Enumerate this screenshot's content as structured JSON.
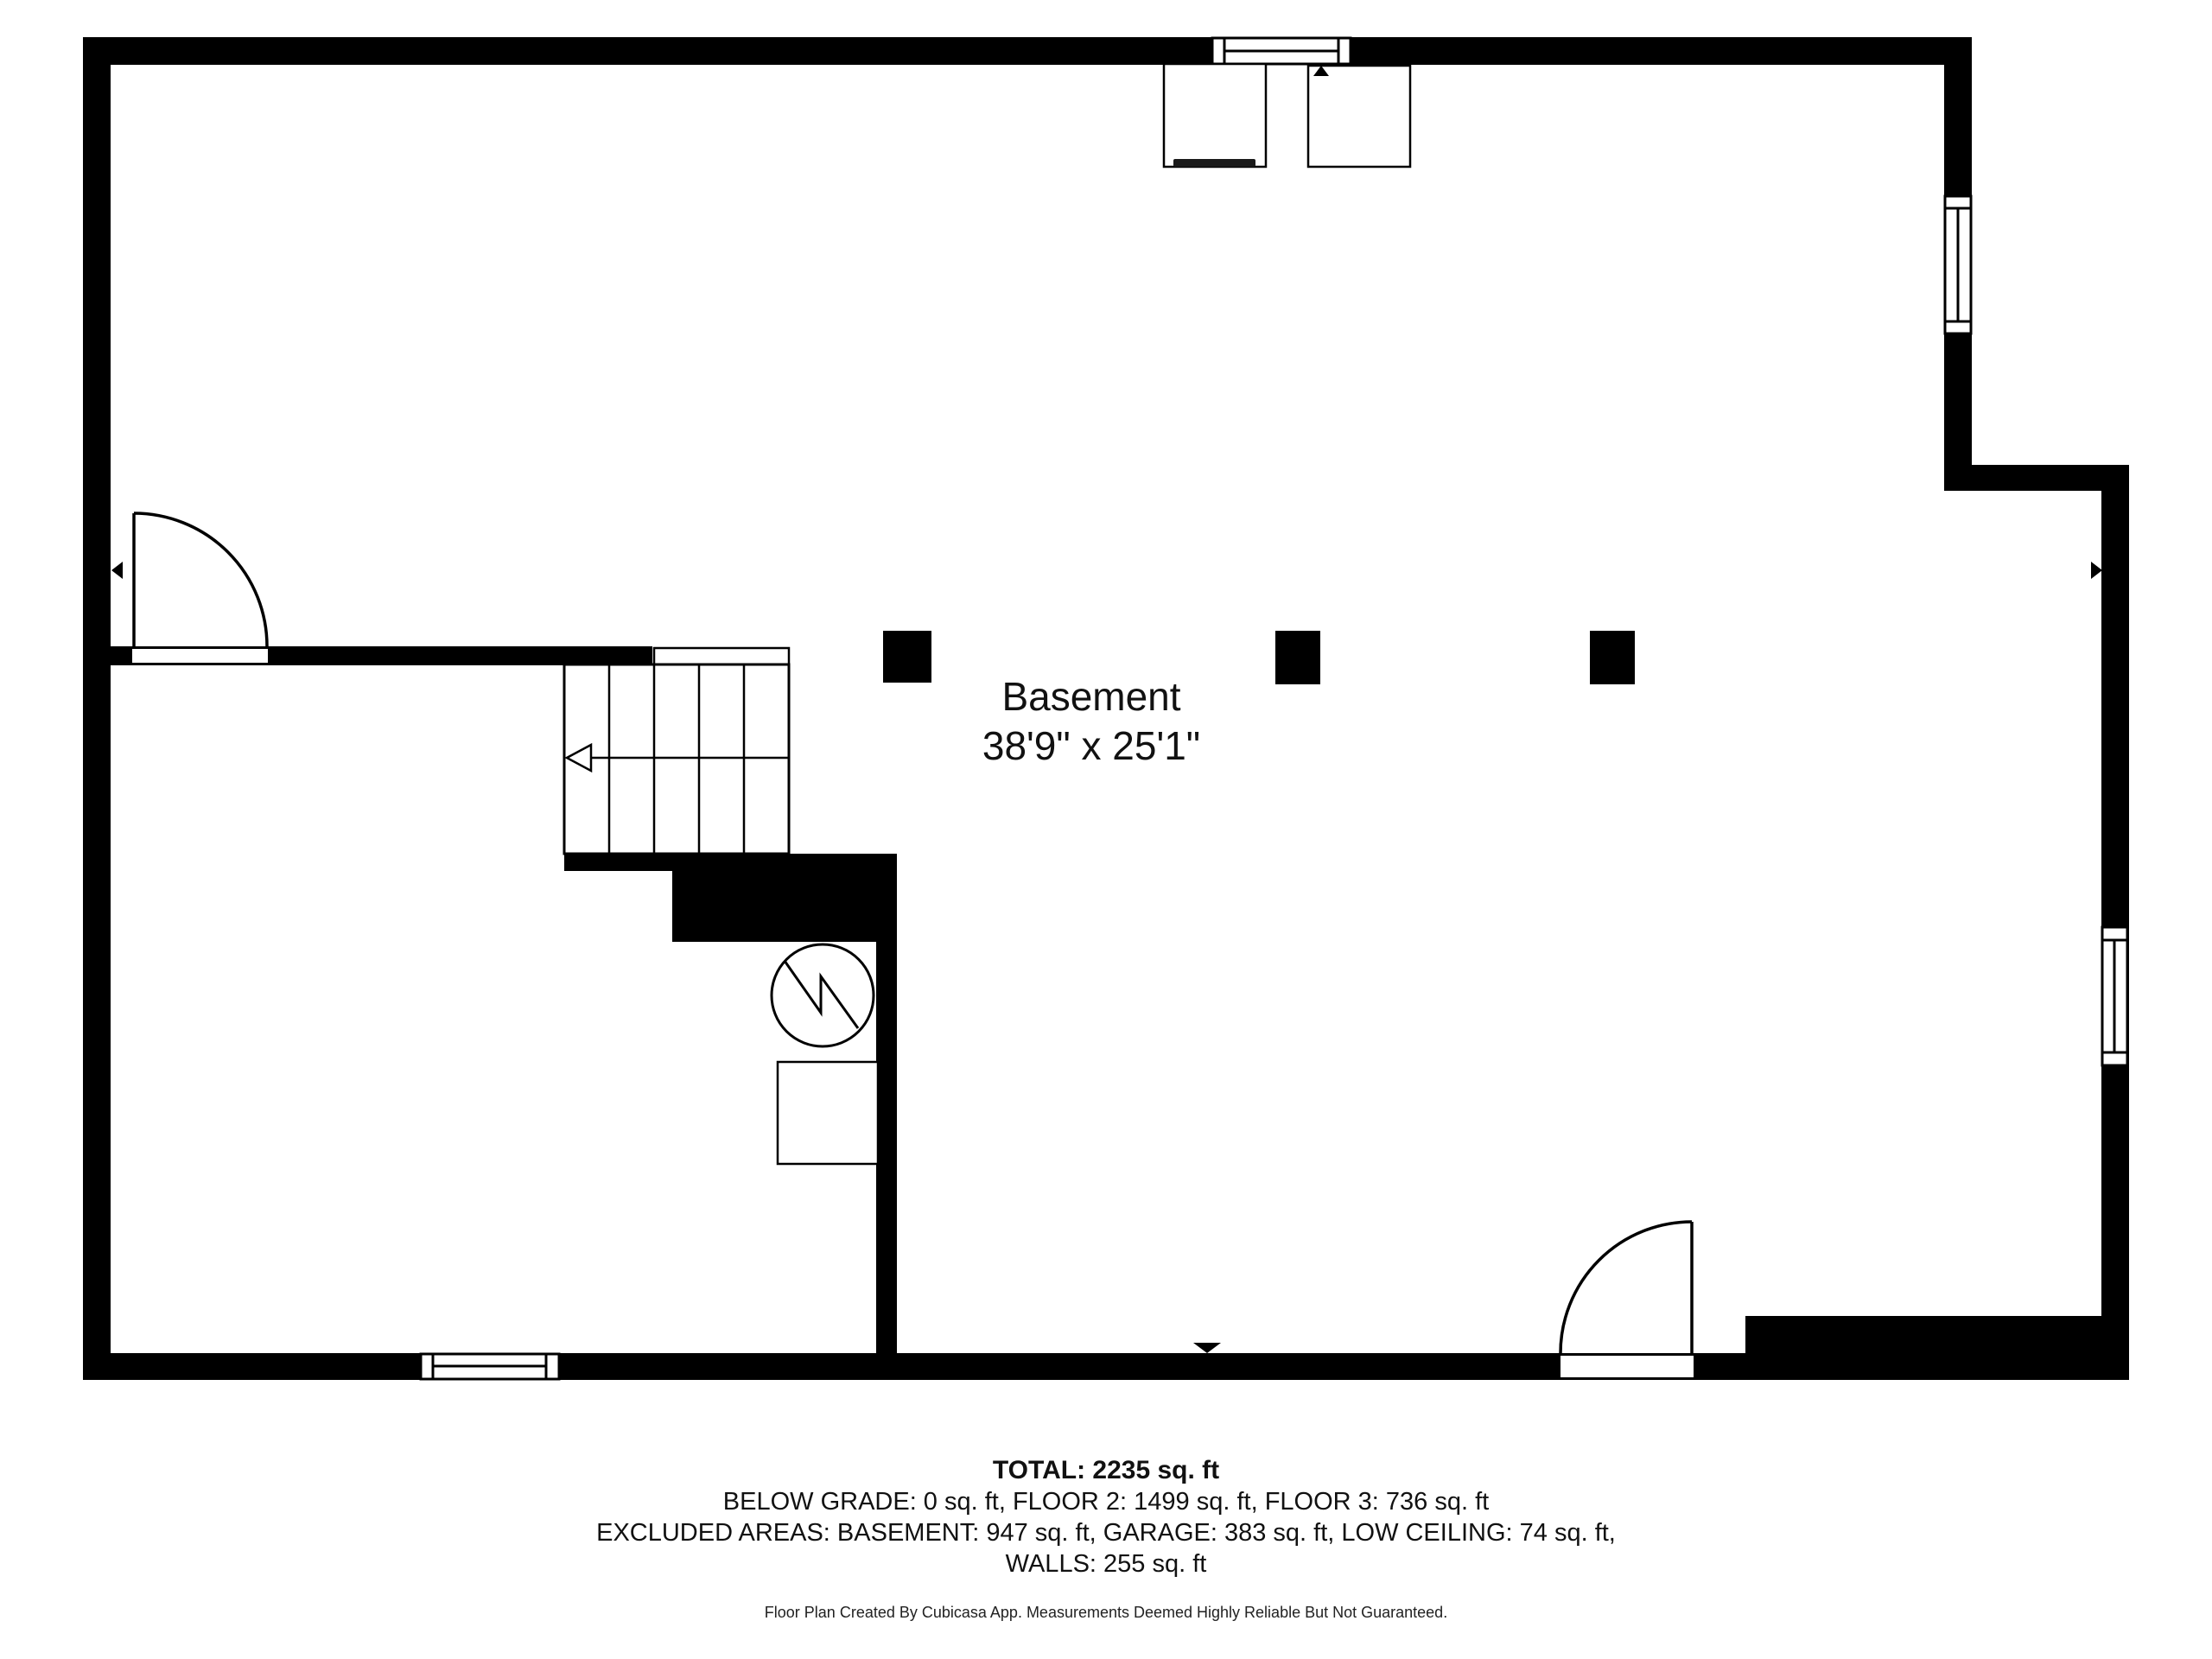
{
  "plan": {
    "room": {
      "name": "Basement",
      "dimensions": "38'9\" x 25'1\""
    },
    "colors": {
      "wall": "#000000",
      "line": "#000000",
      "background": "#ffffff",
      "text": "#111111"
    },
    "icons": {
      "stairs_direction_arrow": "open-triangle-left-with-line",
      "entry_arrow_top": "triangle-up",
      "entry_arrow_bottom": "triangle-down",
      "section_marker_left": "triangle-left",
      "section_marker_right": "triangle-right",
      "utility_symbol": "circle-zigzag",
      "window_symbol": "double-line-rect",
      "door_symbol": "quarter-arc-swing"
    }
  },
  "summary": {
    "total": "TOTAL: 2235 sq. ft",
    "floors": "BELOW GRADE: 0 sq. ft, FLOOR 2: 1499 sq. ft, FLOOR 3: 736 sq. ft",
    "excluded": "EXCLUDED AREAS: BASEMENT: 947 sq. ft, GARAGE: 383 sq. ft, LOW CEILING: 74 sq. ft,",
    "walls": "WALLS: 255 sq. ft",
    "disclaimer": "Floor Plan Created By Cubicasa App. Measurements Deemed Highly Reliable But Not Guaranteed."
  }
}
